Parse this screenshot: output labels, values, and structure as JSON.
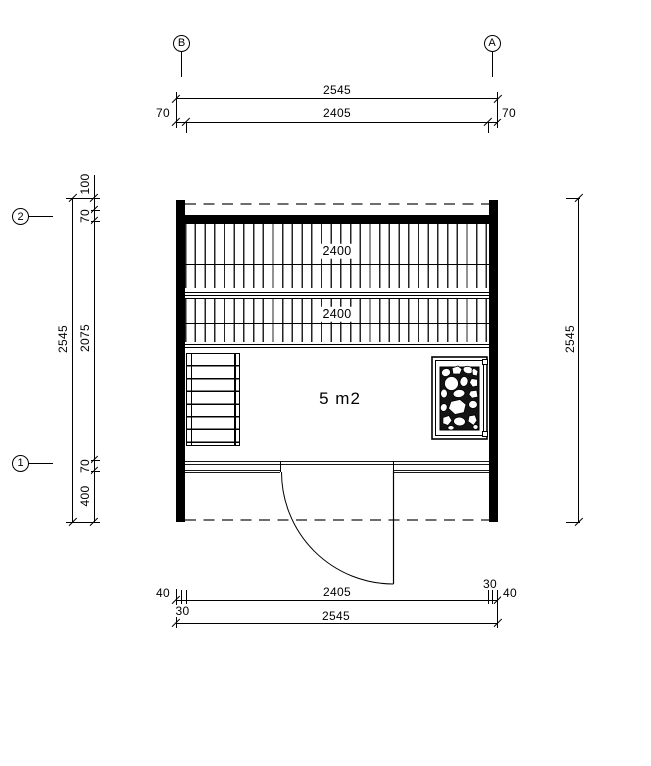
{
  "drawing": {
    "area_label": "5 m2",
    "grid": {
      "b": "B",
      "a": "A",
      "two": "2",
      "one": "1"
    },
    "dims": {
      "top_overall": "2545",
      "top_inner": "2405",
      "top_left_offset": "70",
      "top_right_offset": "70",
      "left_seg_100": "100",
      "left_seg_70_top": "70",
      "left_overall": "2545",
      "left_inner": "2075",
      "left_seg_70_bottom": "70",
      "left_seg_400": "400",
      "right_overall": "2545",
      "bottom_inner": "2405",
      "bottom_overall": "2545",
      "bottom_left_40": "40",
      "bottom_left_30": "30",
      "bottom_right_30": "30",
      "bottom_right_40": "40",
      "bench_upper": "2400",
      "bench_lower": "2400"
    }
  }
}
